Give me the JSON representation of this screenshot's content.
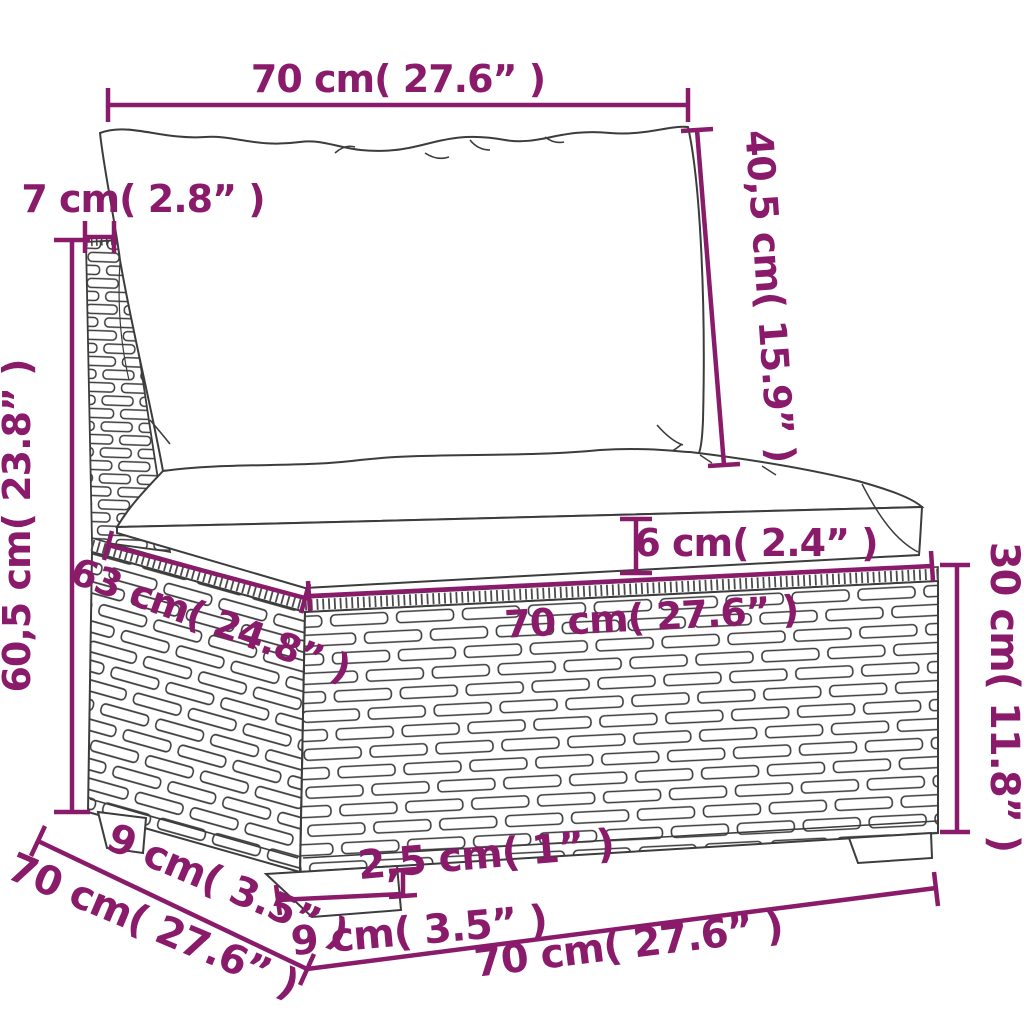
{
  "diagram": {
    "background_color": "#ffffff",
    "accent_color": "#8a1b6b",
    "outline_color": "#3c3c3c",
    "dims": {
      "back_cushion_width": "70 cm( 27.6” )",
      "back_cushion_height": "40,5 cm( 15.9” )",
      "back_frame_width": "7 cm( 2.8” )",
      "total_height": "60,5 cm( 23.8” )",
      "seat_cushion_thickness": "6 cm( 2.4” )",
      "seat_width": "70 cm( 27.6” )",
      "seat_depth": "63 cm( 24.8” )",
      "base_height": "30 cm( 11.8” )",
      "leg_offset_side": "9 cm( 3.5” )",
      "depth_total": "70 cm( 27.6” )",
      "leg_width": "9 cm( 3.5” )",
      "leg_height": "2,5 cm( 1” )",
      "base_width": "70 cm( 27.6” )"
    }
  }
}
